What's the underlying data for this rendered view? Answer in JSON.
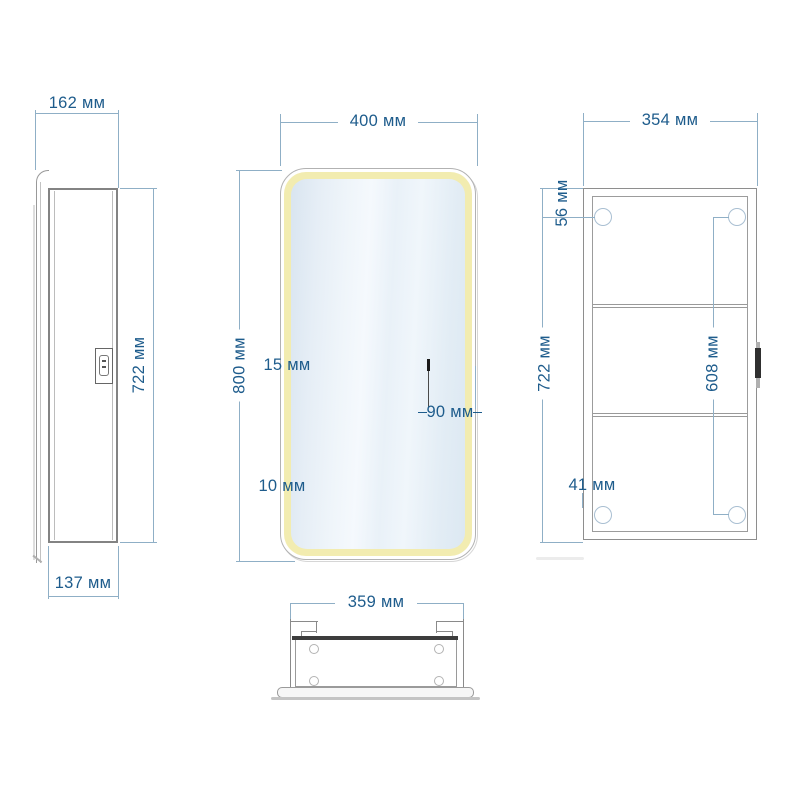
{
  "views": {
    "side": {
      "depth_total": "162 мм",
      "height": "722 мм",
      "depth_body": "137 мм"
    },
    "front": {
      "width": "400 мм",
      "height": "800 мм",
      "led_strip": "15 мм",
      "sensor_offset": "90 мм",
      "bottom_strip": "10 мм"
    },
    "back": {
      "width": "354 мм",
      "height": "722 мм",
      "hole_top_offset": "56 мм",
      "hole_span": "608 мм",
      "hole_bottom_offset": "41 мм"
    },
    "top": {
      "width": "359 мм"
    }
  },
  "colors": {
    "dim_text": "#1e5c8c",
    "dim_line": "#8fafc6",
    "outline": "#8a8a8a",
    "led": "#f2ecb0",
    "glass_light": "#f5f9fd",
    "glass_dark": "#d9e5f0",
    "rail_dark": "#3d3d3d",
    "background": "#ffffff"
  }
}
